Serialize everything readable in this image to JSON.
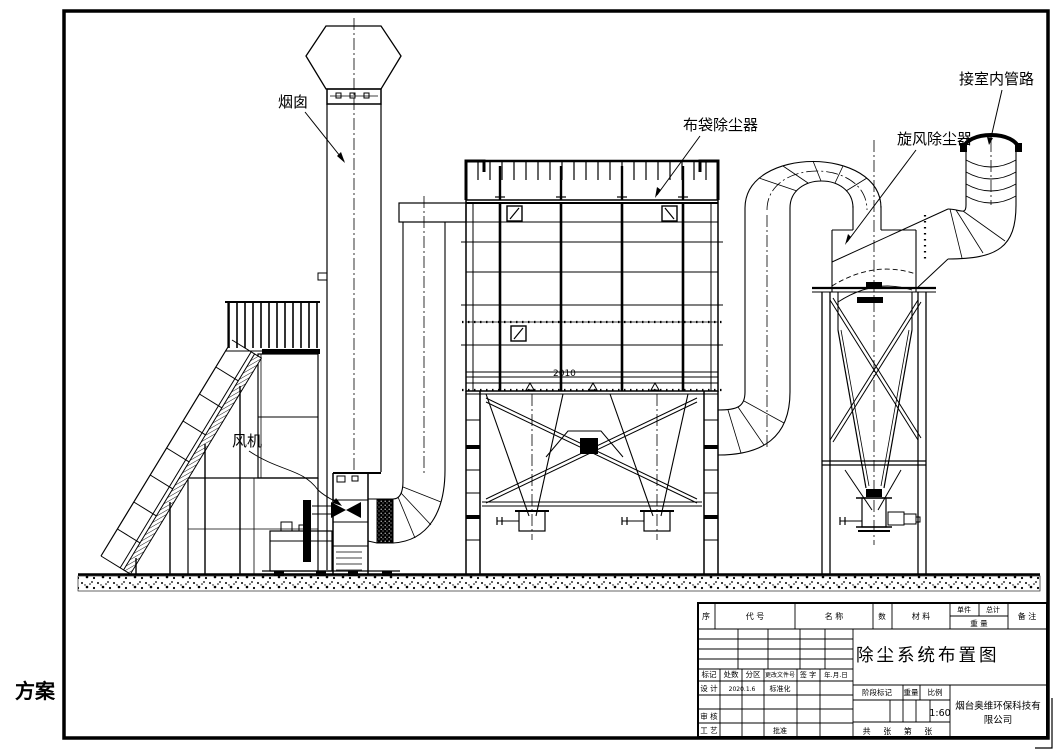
{
  "labels": {
    "chimney": "烟囱",
    "fan": "风机",
    "bag_filter": "布袋除尘器",
    "cyclone": "旋风除尘器",
    "indoor_pipe": "接室内管路",
    "scheme": "方案",
    "dim": "2010"
  },
  "title_block": {
    "title": "除尘系统布置图",
    "bom": {
      "seq": "序",
      "code": "代 号",
      "name": "名 称",
      "qty": "数",
      "material": "材 料",
      "unit": "单件",
      "total": "总计",
      "weight": "重 量",
      "remark": "备 注"
    },
    "rows": {
      "mark": "标记",
      "count": "处数",
      "zone": "分区",
      "change_doc": "更改文件号",
      "sign": "签 字",
      "date_col": "年.月.日",
      "design": "设 计",
      "design_date": "2020.1.6",
      "standardize": "标准化",
      "review": "审 核",
      "process": "工 艺",
      "approve": "批准"
    },
    "stage": {
      "stage_mark": "阶段标记",
      "weight": "重量",
      "scale_label": "比例",
      "scale": "1:60"
    },
    "company": {
      "line1": "烟台奥维环保科技有",
      "line2": "限公司"
    },
    "sheet": "共 张 第 张"
  }
}
